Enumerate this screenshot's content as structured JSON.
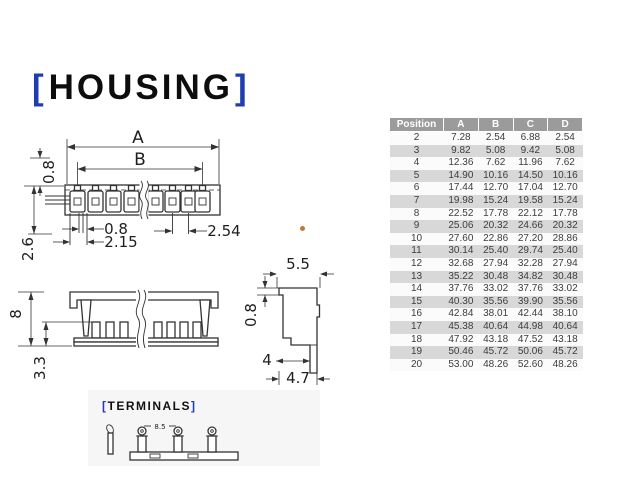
{
  "theme": {
    "accent_bracket": "#1d3db0",
    "drawing_line": "#333333",
    "table_header_bg": "#9b9b9b",
    "table_stripe": "#d8d8d8",
    "table_row": "#fbfbfb",
    "table_text": "#3d3d3d",
    "terminals_box_bg": "#f6f6f6",
    "artifact": "#bd7a35"
  },
  "housing": {
    "bracket_open": "[",
    "title": "HOUSING",
    "bracket_close": "]",
    "front_view": {
      "dim_a": "A",
      "dim_b": "B",
      "dim_tab_height": "0.8",
      "dim_side_height": "2.6",
      "dim_slot_width": "0.8",
      "dim_first_offset": "2.15",
      "dim_pitch": "2.54"
    },
    "section_view": {
      "dim_height": "8",
      "dim_inner_depth": "3.3"
    },
    "profile_view": {
      "dim_top_width": "5.5",
      "dim_notch": "0.8",
      "dim_base_width": "4",
      "dim_overall_depth": "4.7"
    }
  },
  "terminals": {
    "bracket_open": "[",
    "title": "TERMINALS",
    "bracket_close": "]",
    "dim_pitch": "8.5"
  },
  "dimensions_table": {
    "headers": [
      "Position",
      "A",
      "B",
      "C",
      "D"
    ],
    "rows": [
      [
        "2",
        "7.28",
        "2.54",
        "6.88",
        "2.54"
      ],
      [
        "3",
        "9.82",
        "5.08",
        "9.42",
        "5.08"
      ],
      [
        "4",
        "12.36",
        "7.62",
        "11.96",
        "7.62"
      ],
      [
        "5",
        "14.90",
        "10.16",
        "14.50",
        "10.16"
      ],
      [
        "6",
        "17.44",
        "12.70",
        "17.04",
        "12.70"
      ],
      [
        "7",
        "19.98",
        "15.24",
        "19.58",
        "15.24"
      ],
      [
        "8",
        "22.52",
        "17.78",
        "22.12",
        "17.78"
      ],
      [
        "9",
        "25.06",
        "20.32",
        "24.66",
        "20.32"
      ],
      [
        "10",
        "27.60",
        "22.86",
        "27.20",
        "28.86"
      ],
      [
        "11",
        "30.14",
        "25.40",
        "29.74",
        "25.40"
      ],
      [
        "12",
        "32.68",
        "27.94",
        "32.28",
        "27.94"
      ],
      [
        "13",
        "35.22",
        "30.48",
        "34.82",
        "30.48"
      ],
      [
        "14",
        "37.76",
        "33.02",
        "37.76",
        "33.02"
      ],
      [
        "15",
        "40.30",
        "35.56",
        "39.90",
        "35.56"
      ],
      [
        "16",
        "42.84",
        "38.01",
        "42.44",
        "38.10"
      ],
      [
        "17",
        "45.38",
        "40.64",
        "44.98",
        "40.64"
      ],
      [
        "18",
        "47.92",
        "43.18",
        "47.52",
        "43.18"
      ],
      [
        "19",
        "50.46",
        "45.72",
        "50.06",
        "45.72"
      ],
      [
        "20",
        "53.00",
        "48.26",
        "52.60",
        "48.26"
      ]
    ]
  }
}
